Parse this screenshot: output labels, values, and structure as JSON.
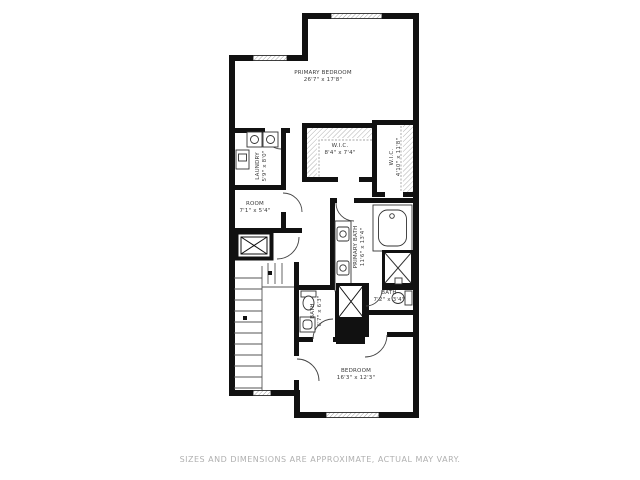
{
  "rooms": {
    "primary_bedroom": {
      "name": "PRIMARY BEDROOM",
      "dims": "26'7\" x 17'8\""
    },
    "wic_1": {
      "name": "W.I.C.",
      "dims": "8'4\" x 7'4\""
    },
    "wic_2": {
      "name": "W.I.C.",
      "dims": "4'10\" x 11'8\""
    },
    "laundry": {
      "name": "LAUNDRY",
      "dims": "5'9\" x 8'0\""
    },
    "room": {
      "name": "ROOM",
      "dims": "7'1\" x 5'4\""
    },
    "primary_bath": {
      "name": "PRIMARY BATH",
      "dims": "11'6\" x 13'4\""
    },
    "bath_left": {
      "name": "BATH",
      "dims": "6'7\" x 6'3\""
    },
    "bath_right": {
      "name": "BATH",
      "dims": "7'2\" x 3'4\""
    },
    "bedroom": {
      "name": "BEDROOM",
      "dims": "16'3\" x 12'3\""
    }
  },
  "footer": {
    "disclaimer": "SIZES AND DIMENSIONS ARE APPROXIMATE, ACTUAL MAY VARY."
  },
  "colors": {
    "background": "#ffffff",
    "wall": "#111111",
    "fixture_line": "#333333",
    "hatch": "#9a9a9a",
    "label_text": "#3a3a3a",
    "disclaimer_text": "#b0b0b0"
  },
  "icons": [
    "bathtub-icon",
    "shower-icon",
    "toilet-icon",
    "sink-icon",
    "vanity-icon",
    "washer-icon",
    "dryer-icon",
    "stairs-icon",
    "elevator-shaft-icon",
    "window-icon",
    "door-arc-icon",
    "closet-hatch-icon"
  ]
}
